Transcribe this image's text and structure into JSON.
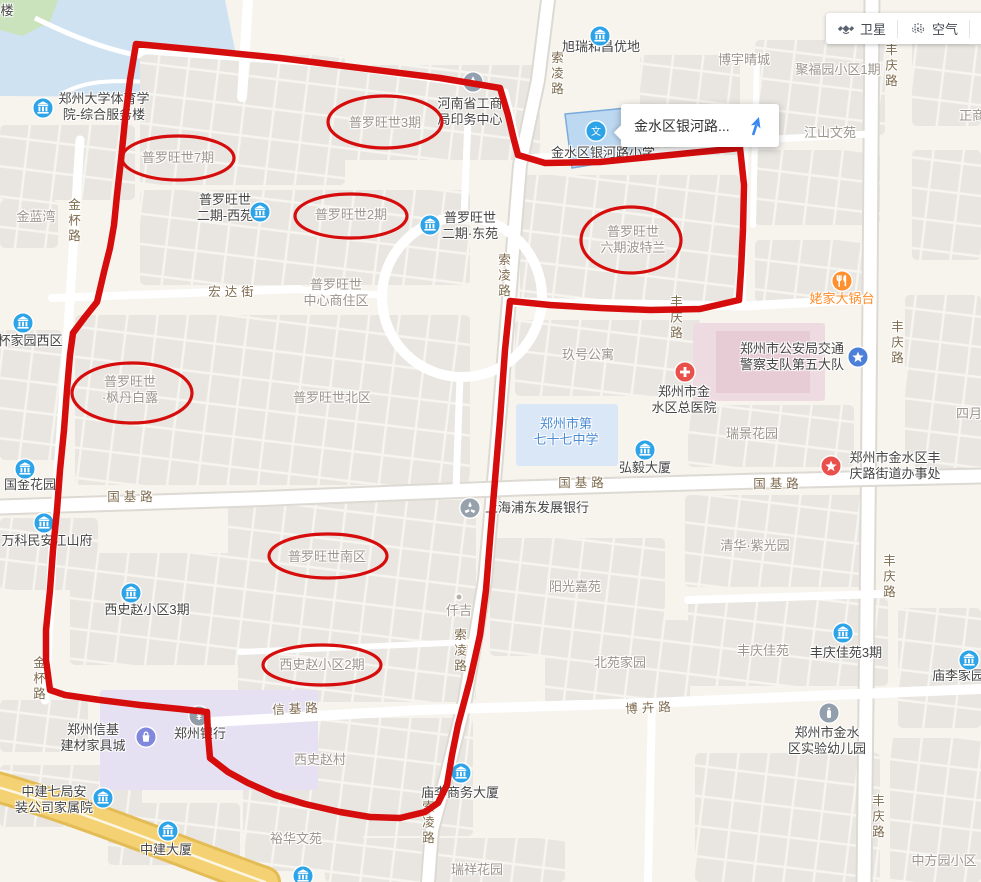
{
  "controls": {
    "satellite": "卫星",
    "air": "空气"
  },
  "popup": {
    "title": "金水区银河路..."
  },
  "colors": {
    "annotation": "#d60d0d"
  },
  "map": {
    "labels": [
      {
        "t": [
          "楼"
        ],
        "x": 7,
        "y": 11,
        "c": "d"
      },
      {
        "t": [
          "郑州大学体育学",
          "院-综合服务楼"
        ],
        "x": 104,
        "y": 107,
        "c": "d"
      },
      {
        "t": [
          "旭瑞和昌优地"
        ],
        "x": 601,
        "y": 47,
        "c": "d"
      },
      {
        "t": [
          "博宇晴城"
        ],
        "x": 744,
        "y": 60,
        "c": "g"
      },
      {
        "t": [
          "聚福园小区1期"
        ],
        "x": 838,
        "y": 70,
        "c": "g"
      },
      {
        "t": [
          "江山文苑"
        ],
        "x": 830,
        "y": 133,
        "c": "g"
      },
      {
        "t": [
          "正商"
        ],
        "x": 972,
        "y": 116,
        "c": "g"
      },
      {
        "t": [
          "河南省工商",
          "局印务中心"
        ],
        "x": 470,
        "y": 112,
        "c": "d"
      },
      {
        "t": [
          "金水区银河路小学"
        ],
        "x": 603,
        "y": 153,
        "c": "d"
      },
      {
        "t": [
          "普罗旺世7期"
        ],
        "x": 178,
        "y": 158,
        "c": "g"
      },
      {
        "t": [
          "普罗旺世3期"
        ],
        "x": 385,
        "y": 123,
        "c": "g"
      },
      {
        "t": [
          "金蓝湾"
        ],
        "x": 36,
        "y": 217,
        "c": "g"
      },
      {
        "t": [
          "普罗旺世",
          "二期-西苑"
        ],
        "x": 225,
        "y": 208,
        "c": "d"
      },
      {
        "t": [
          "普罗旺世2期"
        ],
        "x": 351,
        "y": 215,
        "c": "g"
      },
      {
        "t": [
          "普罗旺世",
          "二期·东苑"
        ],
        "x": 470,
        "y": 226,
        "c": "d"
      },
      {
        "t": [
          "普罗旺世",
          "六期波特兰"
        ],
        "x": 633,
        "y": 240,
        "c": "g"
      },
      {
        "t": [
          "姥家大锅台"
        ],
        "x": 842,
        "y": 299,
        "c": "o"
      },
      {
        "t": [
          "普罗旺世",
          "中心商住区"
        ],
        "x": 336,
        "y": 293,
        "c": "g"
      },
      {
        "t": [
          "宏达街"
        ],
        "x": 233,
        "y": 292,
        "c": "r"
      },
      {
        "t": [
          "普罗旺世",
          "·枫丹白露"
        ],
        "x": 130,
        "y": 390,
        "c": "g"
      },
      {
        "t": [
          "普罗旺世北区"
        ],
        "x": 332,
        "y": 398,
        "c": "g"
      },
      {
        "t": [
          "杯家园西区"
        ],
        "x": 30,
        "y": 341,
        "c": "d"
      },
      {
        "t": [
          "玖号公寓"
        ],
        "x": 588,
        "y": 355,
        "c": "g"
      },
      {
        "t": [
          "郑州市公安局交通",
          "警察支队第五大队"
        ],
        "x": 792,
        "y": 357,
        "c": "d"
      },
      {
        "t": [
          "郑州市金",
          "水区总医院"
        ],
        "x": 684,
        "y": 400,
        "c": "d"
      },
      {
        "t": [
          "瑞景花园"
        ],
        "x": 752,
        "y": 434,
        "c": "g"
      },
      {
        "t": [
          "四月"
        ],
        "x": 969,
        "y": 414,
        "c": "g"
      },
      {
        "t": [
          "郑州市第",
          "七十七中学"
        ],
        "x": 566,
        "y": 432,
        "c": "b"
      },
      {
        "t": [
          "弘毅大厦"
        ],
        "x": 645,
        "y": 468,
        "c": "d"
      },
      {
        "t": [
          "郑州市金水区丰",
          "庆路街道办事处"
        ],
        "x": 895,
        "y": 466,
        "c": "d"
      },
      {
        "t": [
          "国金花园"
        ],
        "x": 30,
        "y": 485,
        "c": "d"
      },
      {
        "t": [
          "国基路"
        ],
        "x": 132,
        "y": 497,
        "c": "r"
      },
      {
        "t": [
          "国基路"
        ],
        "x": 583,
        "y": 483,
        "c": "r"
      },
      {
        "t": [
          "国基路"
        ],
        "x": 778,
        "y": 484,
        "c": "r"
      },
      {
        "t": [
          "万科民安江山府"
        ],
        "x": 47,
        "y": 541,
        "c": "d"
      },
      {
        "t": [
          "上海浦东发展银行"
        ],
        "x": 537,
        "y": 508,
        "c": "d"
      },
      {
        "t": [
          "清华·紫光园"
        ],
        "x": 755,
        "y": 546,
        "c": "g"
      },
      {
        "t": [
          "普罗旺世南区"
        ],
        "x": 327,
        "y": 557,
        "c": "g"
      },
      {
        "t": [
          "阳光嘉苑"
        ],
        "x": 575,
        "y": 587,
        "c": "g"
      },
      {
        "t": [
          "西史赵小区3期"
        ],
        "x": 147,
        "y": 610,
        "c": "d"
      },
      {
        "t": [
          "仟吉"
        ],
        "x": 459,
        "y": 611,
        "c": "g"
      },
      {
        "t": [
          "丰庆佳苑"
        ],
        "x": 763,
        "y": 651,
        "c": "g"
      },
      {
        "t": [
          "丰庆佳苑3期"
        ],
        "x": 846,
        "y": 653,
        "c": "d"
      },
      {
        "t": [
          "北苑家园"
        ],
        "x": 620,
        "y": 663,
        "c": "g"
      },
      {
        "t": [
          "西史赵小区2期"
        ],
        "x": 322,
        "y": 665,
        "c": "g"
      },
      {
        "t": [
          "庙李家园"
        ],
        "x": 958,
        "y": 676,
        "c": "d"
      },
      {
        "t": [
          "信基路"
        ],
        "x": 297,
        "y": 709,
        "c": "r",
        "r": -3
      },
      {
        "t": [
          "博卉路"
        ],
        "x": 650,
        "y": 708,
        "c": "r",
        "r": -3
      },
      {
        "t": [
          "郑州信基",
          "建材家具城"
        ],
        "x": 93,
        "y": 738,
        "c": "d"
      },
      {
        "t": [
          "郑州银行"
        ],
        "x": 200,
        "y": 734,
        "c": "d"
      },
      {
        "t": [
          "郑州市金水",
          "区实验幼儿园"
        ],
        "x": 827,
        "y": 741,
        "c": "d"
      },
      {
        "t": [
          "西史赵村"
        ],
        "x": 320,
        "y": 760,
        "c": "g"
      },
      {
        "t": [
          "庙李商务大厦"
        ],
        "x": 460,
        "y": 793,
        "c": "d"
      },
      {
        "t": [
          "中建七局安",
          "装公司家属院"
        ],
        "x": 54,
        "y": 800,
        "c": "d"
      },
      {
        "t": [
          "裕华文苑"
        ],
        "x": 296,
        "y": 839,
        "c": "g"
      },
      {
        "t": [
          "中建大厦"
        ],
        "x": 166,
        "y": 850,
        "c": "d"
      },
      {
        "t": [
          "瑞祥花园"
        ],
        "x": 477,
        "y": 870,
        "c": "g"
      },
      {
        "t": [
          "中方园小区"
        ],
        "x": 944,
        "y": 861,
        "c": "g"
      },
      {
        "t": [
          "索凌路"
        ],
        "x": 556,
        "y": 74,
        "c": "r",
        "v": 1
      },
      {
        "t": [
          "丰庆路"
        ],
        "x": 890,
        "y": 66,
        "c": "r",
        "v": 1
      },
      {
        "t": [
          "索凌路"
        ],
        "x": 503,
        "y": 276,
        "c": "r",
        "v": 1
      },
      {
        "t": [
          "丰庆路"
        ],
        "x": 675,
        "y": 318,
        "c": "r",
        "v": 1
      },
      {
        "t": [
          "丰庆路"
        ],
        "x": 896,
        "y": 343,
        "c": "r",
        "v": 1
      },
      {
        "t": [
          "丰庆路"
        ],
        "x": 888,
        "y": 577,
        "c": "r",
        "v": 1
      },
      {
        "t": [
          "金杯路"
        ],
        "x": 73,
        "y": 221,
        "c": "r",
        "v": 1
      },
      {
        "t": [
          "金杯路"
        ],
        "x": 38,
        "y": 679,
        "c": "r",
        "v": 1
      },
      {
        "t": [
          "索凌路"
        ],
        "x": 459,
        "y": 651,
        "c": "r",
        "v": 1
      },
      {
        "t": [
          "索凌路"
        ],
        "x": 427,
        "y": 823,
        "c": "r",
        "v": 1
      },
      {
        "t": [
          "丰庆路"
        ],
        "x": 877,
        "y": 817,
        "c": "r",
        "v": 1
      }
    ],
    "pois": [
      {
        "k": "bldg",
        "x": 43,
        "y": 108
      },
      {
        "k": "bldg",
        "x": 600,
        "y": 36
      },
      {
        "k": "print",
        "x": 473,
        "y": 82
      },
      {
        "k": "school",
        "x": 596,
        "y": 131
      },
      {
        "k": "bldg",
        "x": 260,
        "y": 212
      },
      {
        "k": "bldg",
        "x": 430,
        "y": 225
      },
      {
        "k": "food",
        "x": 842,
        "y": 281
      },
      {
        "k": "police",
        "x": 858,
        "y": 357
      },
      {
        "k": "hosp",
        "x": 685,
        "y": 372
      },
      {
        "k": "bldg",
        "x": 645,
        "y": 450
      },
      {
        "k": "gov",
        "x": 831,
        "y": 466
      },
      {
        "k": "bldg",
        "x": 23,
        "y": 323
      },
      {
        "k": "bldg",
        "x": 25,
        "y": 469
      },
      {
        "k": "bldg",
        "x": 44,
        "y": 523
      },
      {
        "k": "bank2",
        "x": 470,
        "y": 508
      },
      {
        "k": "bldg",
        "x": 131,
        "y": 593
      },
      {
        "k": "dot",
        "x": 459,
        "y": 597
      },
      {
        "k": "bldg",
        "x": 843,
        "y": 633
      },
      {
        "k": "bldg",
        "x": 969,
        "y": 660
      },
      {
        "k": "mall",
        "x": 146,
        "y": 737
      },
      {
        "k": "bank",
        "x": 199,
        "y": 716
      },
      {
        "k": "kid",
        "x": 829,
        "y": 713
      },
      {
        "k": "bldg",
        "x": 461,
        "y": 773
      },
      {
        "k": "bldg",
        "x": 103,
        "y": 798
      },
      {
        "k": "bldg",
        "x": 168,
        "y": 831
      },
      {
        "k": "bldg",
        "x": 303,
        "y": 876
      }
    ],
    "annotations": {
      "boundary": [
        [
          136,
          44
        ],
        [
          200,
          50
        ],
        [
          280,
          58
        ],
        [
          360,
          68
        ],
        [
          440,
          78
        ],
        [
          500,
          88
        ],
        [
          508,
          115
        ],
        [
          514,
          140
        ],
        [
          518,
          155
        ],
        [
          545,
          163
        ],
        [
          600,
          162
        ],
        [
          660,
          156
        ],
        [
          700,
          152
        ],
        [
          740,
          148
        ],
        [
          744,
          185
        ],
        [
          743,
          230
        ],
        [
          741,
          270
        ],
        [
          739,
          300
        ],
        [
          700,
          309
        ],
        [
          650,
          310
        ],
        [
          600,
          308
        ],
        [
          550,
          305
        ],
        [
          510,
          301
        ],
        [
          505,
          350
        ],
        [
          500,
          420
        ],
        [
          495,
          480
        ],
        [
          490,
          540
        ],
        [
          486,
          590
        ],
        [
          480,
          635
        ],
        [
          470,
          680
        ],
        [
          458,
          725
        ],
        [
          452,
          755
        ],
        [
          447,
          785
        ],
        [
          438,
          803
        ],
        [
          425,
          812
        ],
        [
          400,
          818
        ],
        [
          370,
          817
        ],
        [
          340,
          812
        ],
        [
          305,
          804
        ],
        [
          275,
          795
        ],
        [
          248,
          783
        ],
        [
          228,
          772
        ],
        [
          210,
          758
        ],
        [
          208,
          735
        ],
        [
          207,
          712
        ],
        [
          180,
          709
        ],
        [
          140,
          705
        ],
        [
          100,
          700
        ],
        [
          65,
          695
        ],
        [
          50,
          690
        ],
        [
          46,
          660
        ],
        [
          46,
          630
        ],
        [
          50,
          590
        ],
        [
          53,
          550
        ],
        [
          57,
          510
        ],
        [
          60,
          470
        ],
        [
          64,
          430
        ],
        [
          67,
          390
        ],
        [
          70,
          355
        ],
        [
          73,
          333
        ],
        [
          85,
          317
        ],
        [
          97,
          302
        ],
        [
          104,
          272
        ],
        [
          110,
          248
        ],
        [
          114,
          225
        ],
        [
          117,
          195
        ],
        [
          121,
          160
        ],
        [
          125,
          120
        ],
        [
          130,
          80
        ],
        [
          136,
          44
        ]
      ],
      "ellipses": [
        [
          178,
          158,
          56,
          22
        ],
        [
          385,
          122,
          57,
          26
        ],
        [
          351,
          216,
          56,
          22
        ],
        [
          631,
          240,
          50,
          33
        ],
        [
          132,
          393,
          60,
          30
        ],
        [
          328,
          556,
          59,
          22
        ],
        [
          322,
          665,
          59,
          20
        ]
      ]
    }
  }
}
